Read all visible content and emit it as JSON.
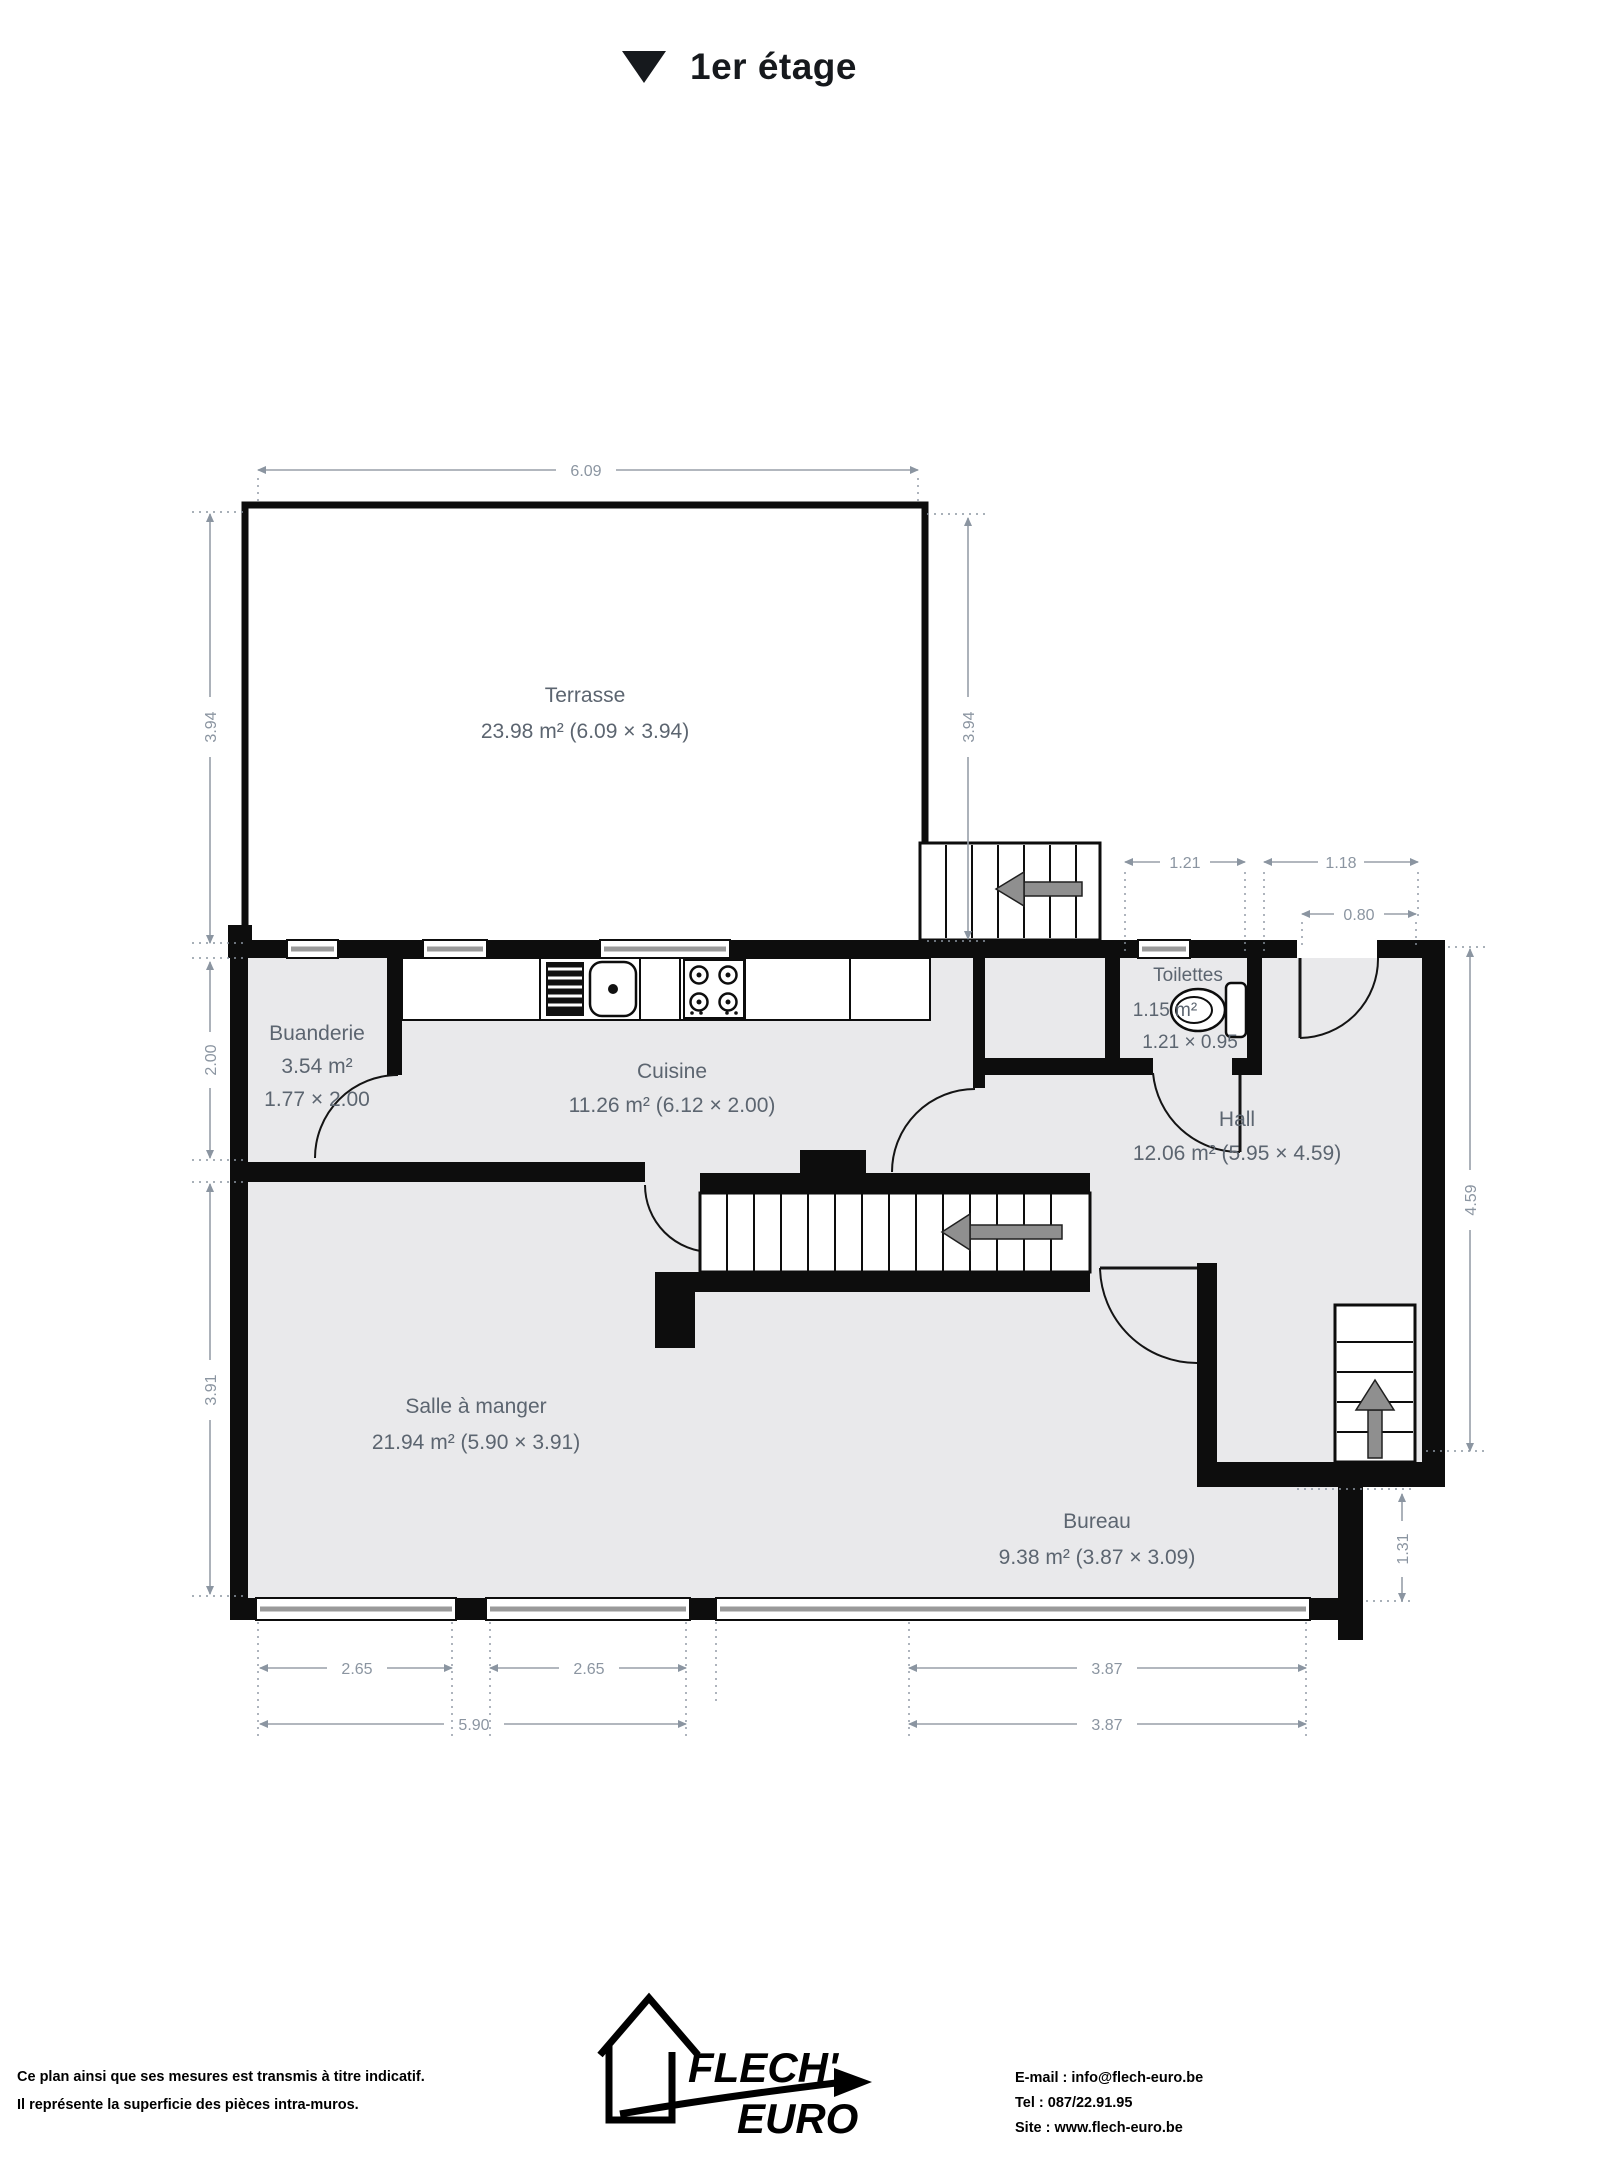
{
  "title": {
    "icon": "collapse-triangle",
    "text": "1er étage"
  },
  "rooms": {
    "terrasse": {
      "name": "Terrasse",
      "area": "23.98 m² (6.09 × 3.94)"
    },
    "buanderie": {
      "name": "Buanderie",
      "area": "3.54 m²",
      "size": "1.77 × 2.00"
    },
    "cuisine": {
      "name": "Cuisine",
      "area": "11.26 m² (6.12 × 2.00)"
    },
    "toilettes": {
      "name": "Toilettes",
      "area": "1.15 m²",
      "size": "1.21 × 0.95"
    },
    "hall": {
      "name": "Hall",
      "area": "12.06 m² (5.95 × 4.59)"
    },
    "salle": {
      "name": "Salle à manger",
      "area": "21.94 m² (5.90 × 3.91)"
    },
    "bureau": {
      "name": "Bureau",
      "area": "9.38 m² (3.87 × 3.09)"
    }
  },
  "dimensions": {
    "terrasse_width": "6.09",
    "terrasse_height_left": "3.94",
    "terrasse_height_right": "3.94",
    "toilettes_width": "1.21",
    "entrance_width": "1.18",
    "entrance_door": "0.80",
    "buanderie_height": "2.00",
    "salle_height": "3.91",
    "hall_height": "4.59",
    "bureau_side": "1.31",
    "window_left_1": "2.65",
    "window_left_2": "2.65",
    "bureau_width_top": "3.87",
    "salle_width": "5.90",
    "bureau_width_bottom": "3.87"
  },
  "footer": {
    "disclaimer_line1": "Ce plan ainsi que ses mesures est transmis à titre indicatif.",
    "disclaimer_line2": "Il représente la superficie des pièces intra-muros.",
    "logo_line1": "FLECH'",
    "logo_line2": "EURO",
    "contact_email": "E-mail : info@flech-euro.be",
    "contact_tel": "Tel : 087/22.91.95",
    "contact_site": "Site : www.flech-euro.be"
  },
  "colors": {
    "wall": "#0d0d0d",
    "floor": "#e9e9eb",
    "room_label": "#5c6570",
    "dimension_label": "#8b95a1",
    "background": "#ffffff"
  }
}
